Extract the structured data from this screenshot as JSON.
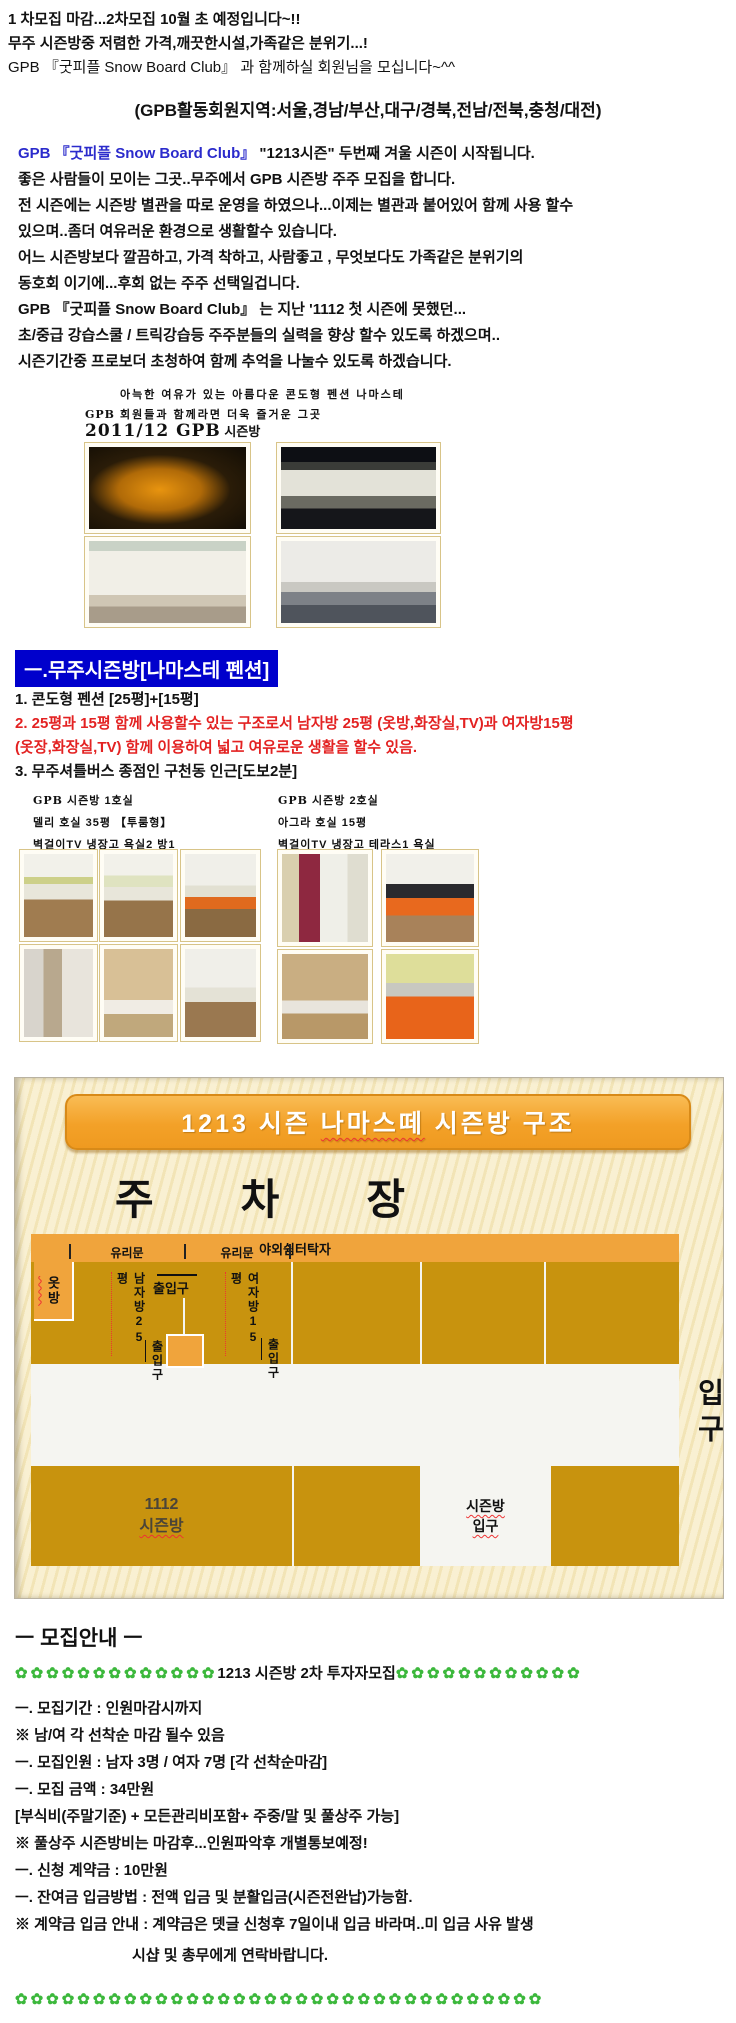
{
  "colors": {
    "link_blue": "#2b2bcc",
    "section_header_bg": "#0000cc",
    "red_text": "#e32222",
    "diagram_orange": "#f0a43c",
    "diagram_gold": "#c8930e",
    "flower_green": "#3cb83c"
  },
  "intro": {
    "line1": "1 차모집 마감...2차모집 10월 초 예정입니다~!!",
    "line2": "무주 시즌방중 저렴한 가격,깨끗한시설,가족같은 분위기...!",
    "line3": "GPB 『굿피플 Snow Board Club』 과 함께하실 회원님을 모십니다~^^",
    "region": "(GPB활동회원지역:서울,경남/부산,대구/경북,전남/전북,충청/대전)"
  },
  "description": {
    "line1_blue": "GPB 『굿피플 Snow Board Club』",
    "line1_rest": " \"1213시즌\" 두번째 겨울 시즌이 시작됩니다.",
    "lines": [
      "좋은 사람들이 모이는 그곳..무주에서 GPB 시즌방 주주 모집을 합니다.",
      "전 시즌에는 시즌방 별관을 따로 운영을 하였으나...이제는 별관과 붙어있어 함께 사용 할수",
      "있으며..좀더 여유러운 환경으로 생활할수 있습니다.",
      "어느 시즌방보다 깔끔하고, 가격 착하고, 사람좋고 , 무엇보다도 가족같은 분위기의",
      "동호회 이기에...후회 없는 주주 선택일겁니다.",
      "GPB 『굿피플 Snow Board Club』 는 지난 '1112 첫 시즌에 못했던...",
      "초/중급 강습스쿨 / 트릭강습등 주주분들의 실력을 향상 할수 있도록 하겠으며..",
      "시즌기간중 프로보더 초청하여 함께 추억을 나눌수 있도록 하겠습니다."
    ]
  },
  "pension_intro": {
    "line1": "아늑한 여유가 있는 아름다운 콘도형 펜션 나마스테",
    "line2_logo": "GPB",
    "line2_rest": " 회원들과 함께라면 더욱 즐거운 그곳",
    "heading_bold": "2011/12 GPB",
    "heading_rest": " 시즌방"
  },
  "section1": {
    "title": "ㅡ.무주시즌방[나마스테 펜션]",
    "item1": "1. 콘도형 펜션 [25평]+[15평]",
    "item2a": "2. 25평과 15평 함께 사용할수 있는 구조로서 남자방 25평 (옷방,화장실,TV)과 여자방15평",
    "item2b": "(옷장,화장실,TV) 함께 이용하여 넓고 여유로운 생활을 할수 있음.",
    "item3": "3. 무주셔틀버스 종점인 구천동 인근[도보2분]"
  },
  "room1": {
    "cap1_logo": "GPB",
    "cap1_rest": " 시즌방 1호실",
    "cap2": "델리 호실 35평 【투룸형】",
    "cap3": "벽걸이TV 냉장고 욕실2 방1"
  },
  "room2": {
    "cap1_logo": "GPB",
    "cap1_rest": " 시즌방 2호실",
    "cap2": "아그라 호실 15평",
    "cap3": "벽걸이TV 냉장고 테라스1 욕실"
  },
  "diagram": {
    "title_seg1": "1213 시즌 ",
    "title_seg2": "나마스떼",
    "title_seg3": " 시즌방 ",
    "title_seg4": "구조",
    "parking_char1": "주",
    "parking_char2": "차",
    "parking_char3": "장",
    "outdoor_table": "야외쉼터탁자",
    "glass_door_1": "유리문",
    "glass_door_2": "유리문",
    "closet": "옷방",
    "men_room": "남자방25평",
    "women_room": "여자방15평",
    "entrance_mid": "출입구",
    "entrance_bottom_left": "출입구",
    "entrance_bottom_right": "출입구",
    "room_1112_line1": "1112",
    "room_1112_line2": "시즌방",
    "season_entrance_line1": "시즌방",
    "season_entrance_line2": "입구",
    "main_entrance": "입구"
  },
  "recruit": {
    "heading": "ㅡ 모집안내 ㅡ",
    "flowers_left": "✿✿✿✿✿✿✿✿✿✿✿✿✿",
    "banner_text": "1213 시즌방 2차 투자자모집",
    "flowers_right": "✿✿✿✿✿✿✿✿✿✿✿✿",
    "lines": [
      "ㅡ. 모집기간 : 인원마감시까지",
      "※ 남/여 각 선착순 마감 될수 있음",
      "ㅡ. 모집인원 : 남자 3명 / 여자 7명 [각 선착순마감]",
      "ㅡ. 모집 금액 : 34만원",
      "[부식비(주말기준) + 모든관리비포함+ 주중/말 및 풀상주 가능]",
      "※ 풀상주 시즌방비는 마감후...인원파악후 개별통보예정!",
      "ㅡ. 신청 계약금 : 10만원",
      "ㅡ. 잔여금 입금방법 : 전액 입금 및 분활입금(시즌전완납)가능함.",
      "※ 계약금 입금 안내 : 계약금은 뎃글 신청후 7일이내 입금 바라며..미 입금 사유 발생"
    ],
    "footer": "시샵 및 총무에게 연락바랍니다.",
    "flowers_bottom": "✿✿✿✿✿✿✿✿✿✿✿✿✿✿✿✿✿✿✿✿✿✿✿✿✿✿✿✿✿✿✿✿✿✿"
  }
}
